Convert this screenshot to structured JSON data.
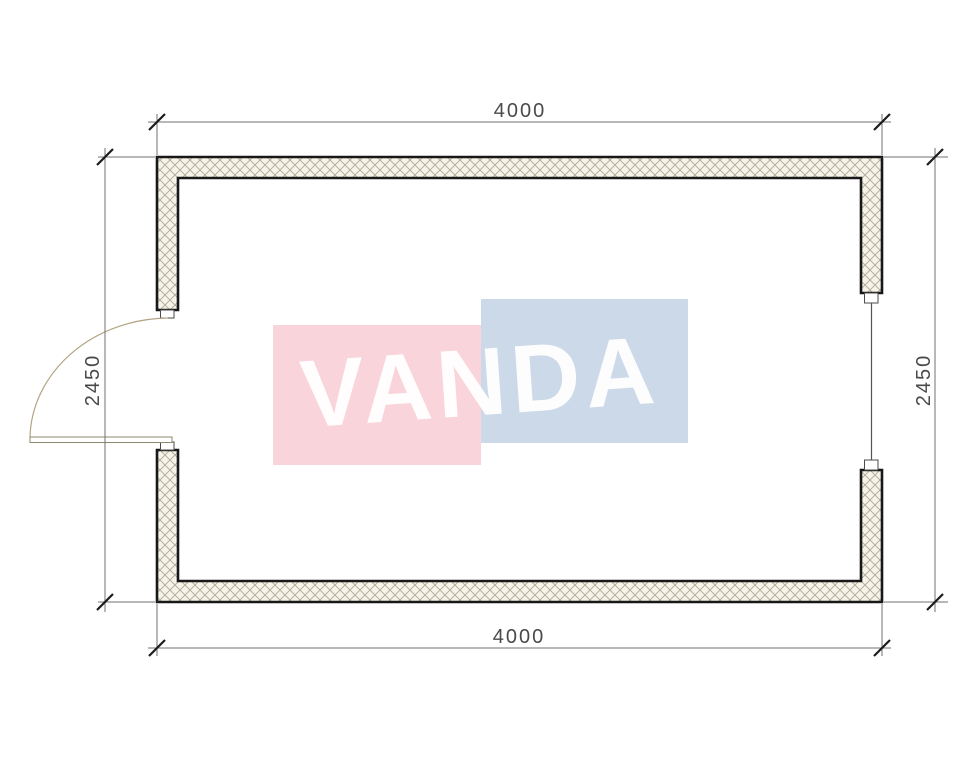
{
  "plan": {
    "dimensions": {
      "top": "4000",
      "bottom": "4000",
      "left": "2450",
      "right": "2450"
    }
  },
  "watermark": {
    "text": "VANDA",
    "pink_color": "#f9d4da",
    "blue_color": "#ccd9e9",
    "text_color": "#ffffff"
  },
  "drawing_colors": {
    "wall_outline": "#181818",
    "hatch_line": "#b0a893",
    "hatch_fill": "#f6f3ea",
    "dimension_line": "#707070",
    "dimension_text": "#4a4a4a",
    "door_arc": "#b3a584"
  }
}
